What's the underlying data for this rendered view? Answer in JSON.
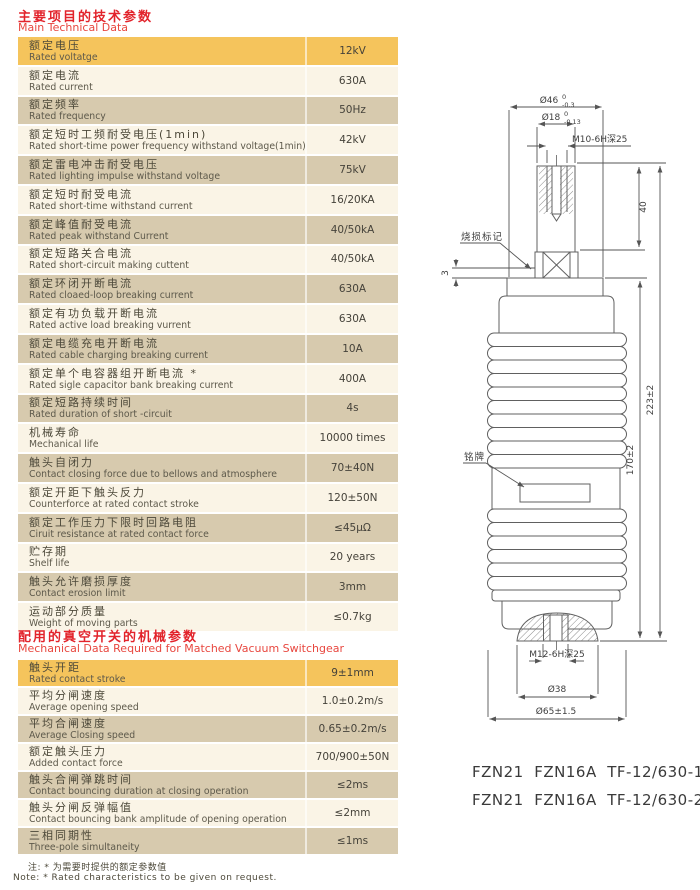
{
  "section1": {
    "title_zh": "主要项目的技术参数",
    "title_en": "Main Technical Data",
    "rows": [
      {
        "zh": "额定电压",
        "en": "Rated voltatge",
        "value": "12kV",
        "tone": "gold"
      },
      {
        "zh": "额定电流",
        "en": "Rated current",
        "value": "630A",
        "tone": "cream"
      },
      {
        "zh": "额定频率",
        "en": "Rated frequency",
        "value": "50Hz",
        "tone": "tan"
      },
      {
        "zh": "额定短时工频耐受电压(1min)",
        "en": "Rated short-time power frequency withstand voltage(1min)",
        "value": "42kV",
        "tone": "cream"
      },
      {
        "zh": "额定雷电冲击耐受电压",
        "en": "Rated lighting impulse withstand voltage",
        "value": "75kV",
        "tone": "tan"
      },
      {
        "zh": "额定短时耐受电流",
        "en": "Rated short-time withstand current",
        "value": "16/20KA",
        "tone": "cream"
      },
      {
        "zh": "额定峰值耐受电流",
        "en": "Rated peak withstand Current",
        "value": "40/50kA",
        "tone": "tan"
      },
      {
        "zh": "额定短路关合电流",
        "en": "Rated short-circuit making cuttent",
        "value": "40/50kA",
        "tone": "cream"
      },
      {
        "zh": "额定环闭开断电流",
        "en": "Rated cloaed-loop breaking current",
        "value": "630A",
        "tone": "tan"
      },
      {
        "zh": "额定有功负载开断电流",
        "en": "Rated active load breaking vurrent",
        "value": "630A",
        "tone": "cream"
      },
      {
        "zh": "额定电缆充电开断电流",
        "en": "Rated cable charging breaking current",
        "value": "10A",
        "tone": "tan"
      },
      {
        "zh": "额定单个电容器组开断电流 *",
        "en": "Rated sigle capacitor bank breaking current",
        "value": "400A",
        "tone": "cream"
      },
      {
        "zh": "额定短路持续时间",
        "en": "Rated duration of short -circuit",
        "value": "4s",
        "tone": "tan"
      },
      {
        "zh": "机械寿命",
        "en": "Mechanical life",
        "value": "10000 times",
        "tone": "cream"
      },
      {
        "zh": "触头自闭力",
        "en": "Contact closing force due to bellows and atmosphere",
        "value": "70±40N",
        "tone": "tan"
      },
      {
        "zh": "额定开距下触头反力",
        "en": "Counterforce at rated contact stroke",
        "value": "120±50N",
        "tone": "cream"
      },
      {
        "zh": "额定工作压力下限时回路电阻",
        "en": "Ciruit resistance at rated contact force",
        "value": "≤45μΩ",
        "tone": "tan"
      },
      {
        "zh": "贮存期",
        "en": "Shelf life",
        "value": "20 years",
        "tone": "cream"
      },
      {
        "zh": "触头允许磨损厚度",
        "en": "Contact erosion limit",
        "value": "3mm",
        "tone": "tan"
      },
      {
        "zh": "运动部分质量",
        "en": "Weight of moving parts",
        "value": "≤0.7kg",
        "tone": "cream"
      }
    ]
  },
  "section2": {
    "title_zh": "配用的真空开关的机械参数",
    "title_en": "Mechanical Data Required for Matched Vacuum Switchgear",
    "rows": [
      {
        "zh": "触头开距",
        "en": "Rated contact stroke",
        "value": "9±1mm",
        "tone": "gold"
      },
      {
        "zh": "平均分闸速度",
        "en": "Average opening speed",
        "value": "1.0±0.2m/s",
        "tone": "cream"
      },
      {
        "zh": "平均合闸速度",
        "en": "Average Closing speed",
        "value": "0.65±0.2m/s",
        "tone": "tan"
      },
      {
        "zh": "额定触头压力",
        "en": "Added contact force",
        "value": "700/900±50N",
        "tone": "cream"
      },
      {
        "zh": "触头合闸弹跳时间",
        "en": "Contact bouncing duration at closing operation",
        "value": "≤2ms",
        "tone": "tan"
      },
      {
        "zh": "触头分闸反弹幅值",
        "en": "Contact bouncing bank amplitude of opening operation",
        "value": "≤2mm",
        "tone": "cream"
      },
      {
        "zh": "三相同期性",
        "en": "Three-pole simultaneity",
        "value": "≤1ms",
        "tone": "tan"
      }
    ]
  },
  "note": {
    "zh": "注: * 为需要时提供的额定参数值",
    "en": "Note: * Rated characteristics to be given on request."
  },
  "models": {
    "line1": "FZN21  FZN16A  TF-12/630-16",
    "line2": "FZN21  FZN16A  TF-12/630-20"
  },
  "drawing": {
    "labels": {
      "dia46": "Ø46",
      "dia46_tol_up": "0",
      "dia46_tol_dn": "-0.3",
      "dia18": "Ø18",
      "dia18_tol_up": "0",
      "dia18_tol_dn": "-0.13",
      "thread_top": "M10-6H深25",
      "dim40": "40",
      "dim3": "3",
      "burn_mark": "烧损标记",
      "nameplate": "铭牌",
      "dim223": "223±2",
      "dim170": "170±2",
      "thread_bottom": "M12-6H深25",
      "dia38": "Ø38",
      "dia65": "Ø65±1.5"
    }
  },
  "colors": {
    "accent_red": "#e2232b",
    "row_gold": "#f5c45c",
    "row_tan": "#d7caae",
    "row_cream": "#faf4e6",
    "line_gray": "#606060"
  }
}
